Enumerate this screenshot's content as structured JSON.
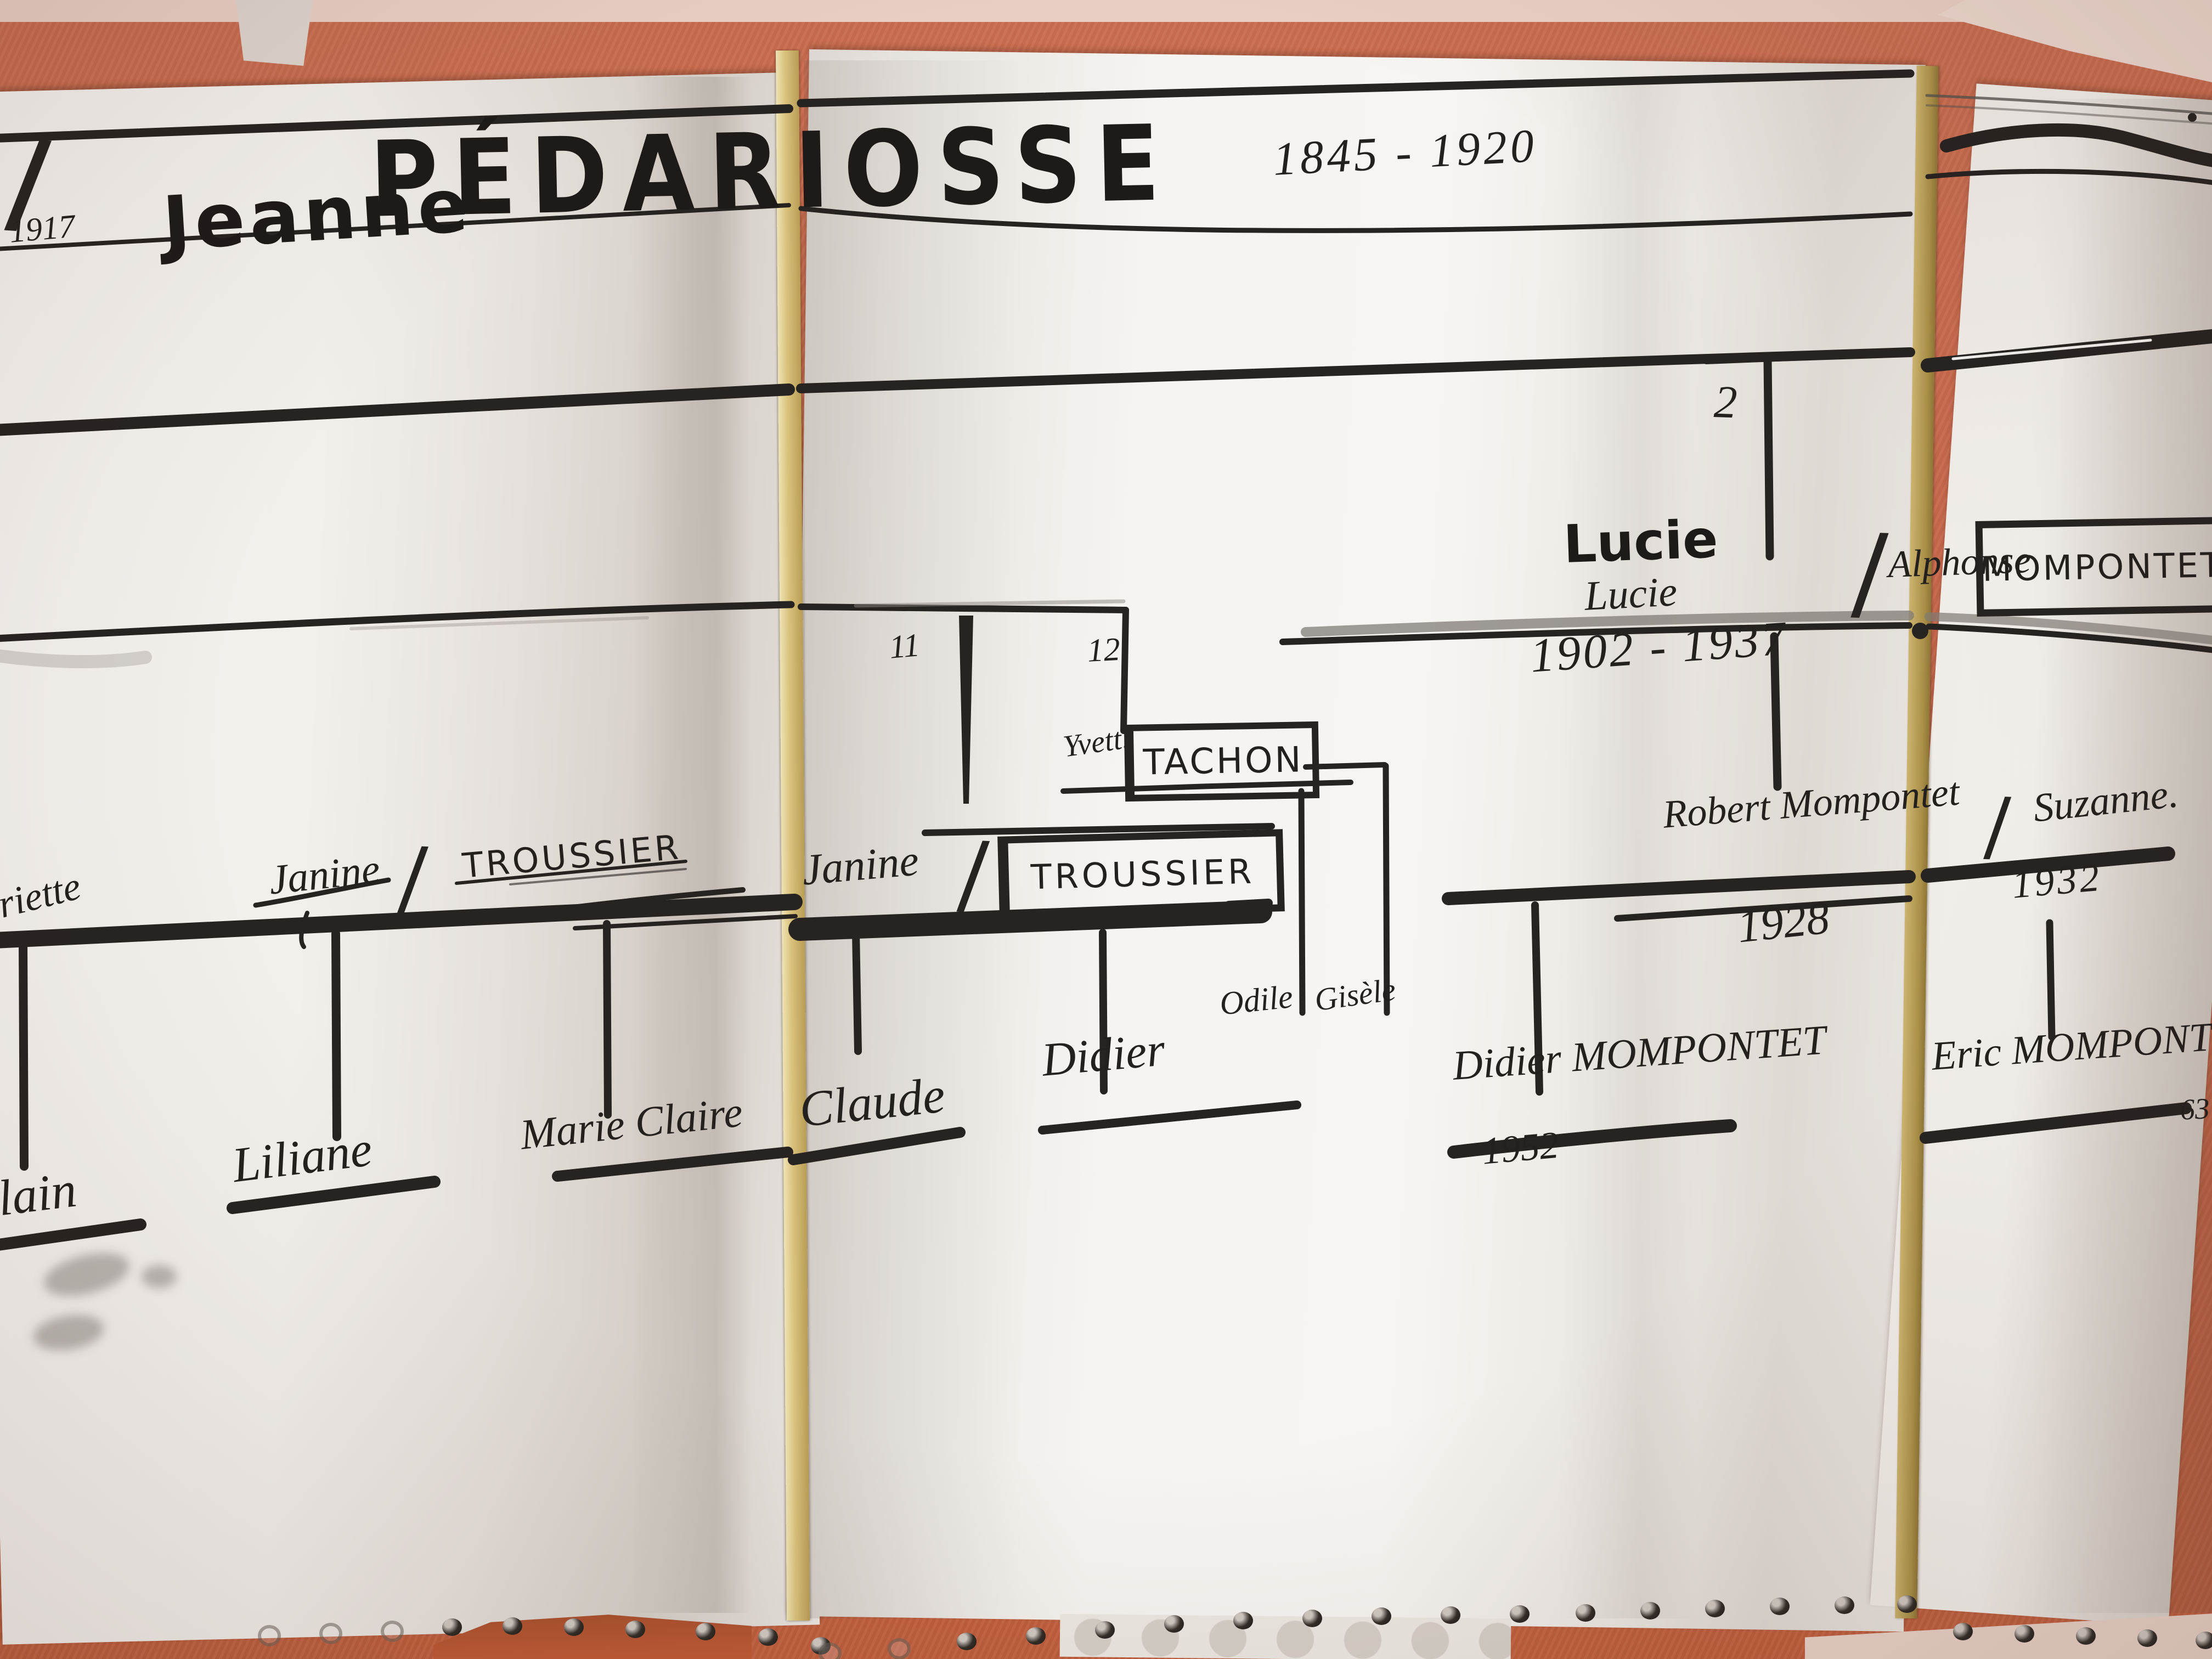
{
  "photo_subject": "Hand-drawn family tree on folded perforated paper, photographed on orange fabric",
  "tree": {
    "separator": "/",
    "title": {
      "first_name": "Jeanne",
      "surname": "PÉDARIOSSE",
      "life_dates": "1845 - 1920",
      "marriage_year": "1917"
    },
    "lucie_branch": {
      "branch_number": "2",
      "name_marker": "Lucie",
      "name_pen": "Lucie",
      "life_dates": "1902 - 1937",
      "spouse_first_name": "Alphonse",
      "spouse_surname": "MOMPONTET"
    },
    "left_branch": {
      "wife_name_fragment": "riette",
      "name": "Janine",
      "spouse_surname": "TROUSSIER",
      "children": [
        "lain",
        "Liliane",
        "Marie Claire"
      ]
    },
    "middle_branch": {
      "branch_number_janine": "11",
      "branch_number_yvette": "12",
      "yvette_name": "Yvett.",
      "yvette_surname": "TACHON",
      "janine_name": "Janine",
      "janine_spouse_surname": "TROUSSIER",
      "children_tachon": [
        "Odile",
        "Gisèle"
      ],
      "children_troussier": [
        "Claude",
        "Didier"
      ]
    },
    "mompontet_branch": {
      "husband": "Robert Mompontet",
      "wife": "Suzanne.",
      "husband_year": "1928",
      "wife_year": "1932",
      "son": "Didier MOMPONTET",
      "son_year": "1952",
      "grandson": "Eric MOMPONTET",
      "grandson_note": "63"
    }
  }
}
